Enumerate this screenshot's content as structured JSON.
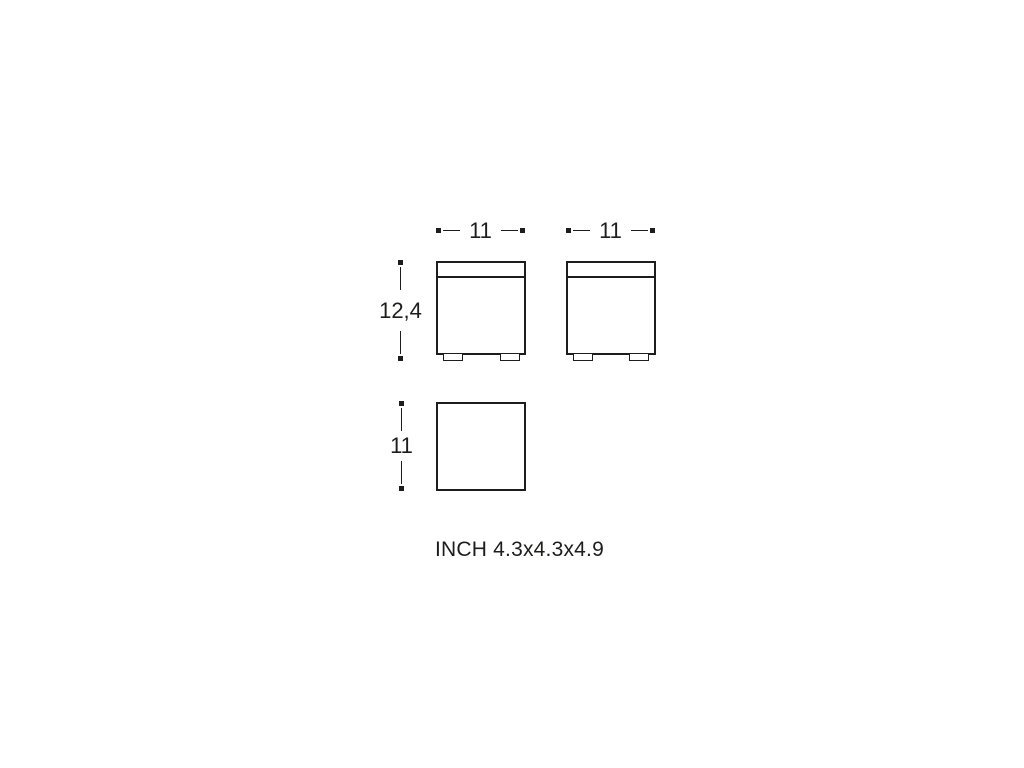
{
  "diagram": {
    "ink_color": "#1d1d1b",
    "background_color": "#ffffff",
    "dimensions": {
      "front_width_left": "11",
      "front_width_right": "11",
      "total_height": "12,4",
      "top_depth": "11"
    },
    "caption": "INCH 4.3x4.3x4.9"
  }
}
